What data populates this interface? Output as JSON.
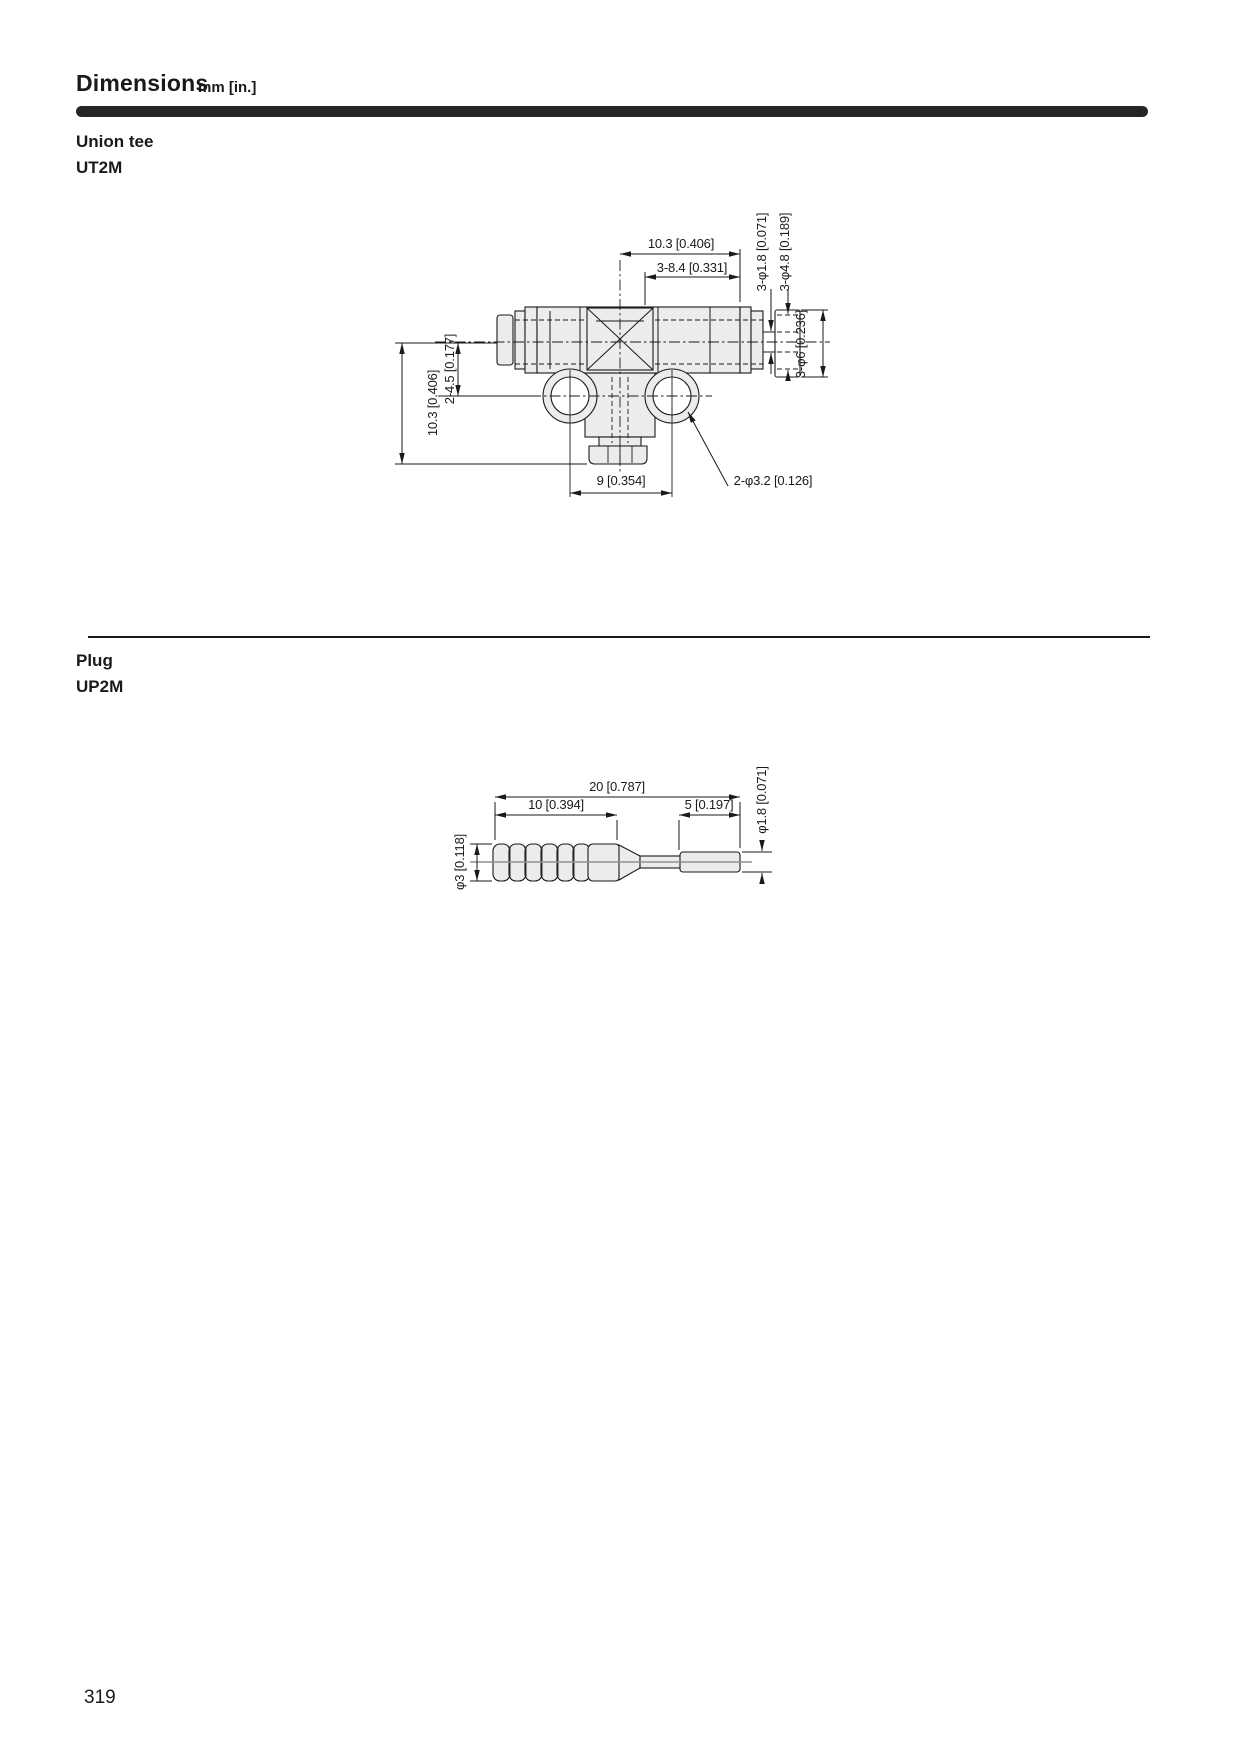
{
  "header": {
    "title": "Dimensions",
    "units": "mm [in.]"
  },
  "sections": {
    "union_tee": {
      "label": "Union tee",
      "model": "UT2M",
      "dims": {
        "top_width": "10.3 [0.406]",
        "port_depth": "3-8.4 [0.331]",
        "hole_dia_small": "3-φ1.8 [0.071]",
        "hole_dia_mid": "3-φ4.8 [0.189]",
        "hole_dia_outer": "3-φ6 [0.236]",
        "center_offset": "2-4.5 [0.177]",
        "height": "10.3 [0.406]",
        "hole_pitch": "9 [0.354]",
        "hole_dia_bottom": "2-φ3.2 [0.126]"
      }
    },
    "plug": {
      "label": "Plug",
      "model": "UP2M",
      "dims": {
        "total_length": "20 [0.787]",
        "barb_length": "10 [0.394]",
        "tip_length": "5 [0.197]",
        "barb_dia": "φ3 [0.118]",
        "tip_dia": "φ1.8 [0.071]"
      }
    }
  },
  "footer": {
    "page_number": "319"
  },
  "colors": {
    "ink": "#1a1a1a",
    "title_bar": "#262626",
    "part_fill": "#ececec"
  }
}
